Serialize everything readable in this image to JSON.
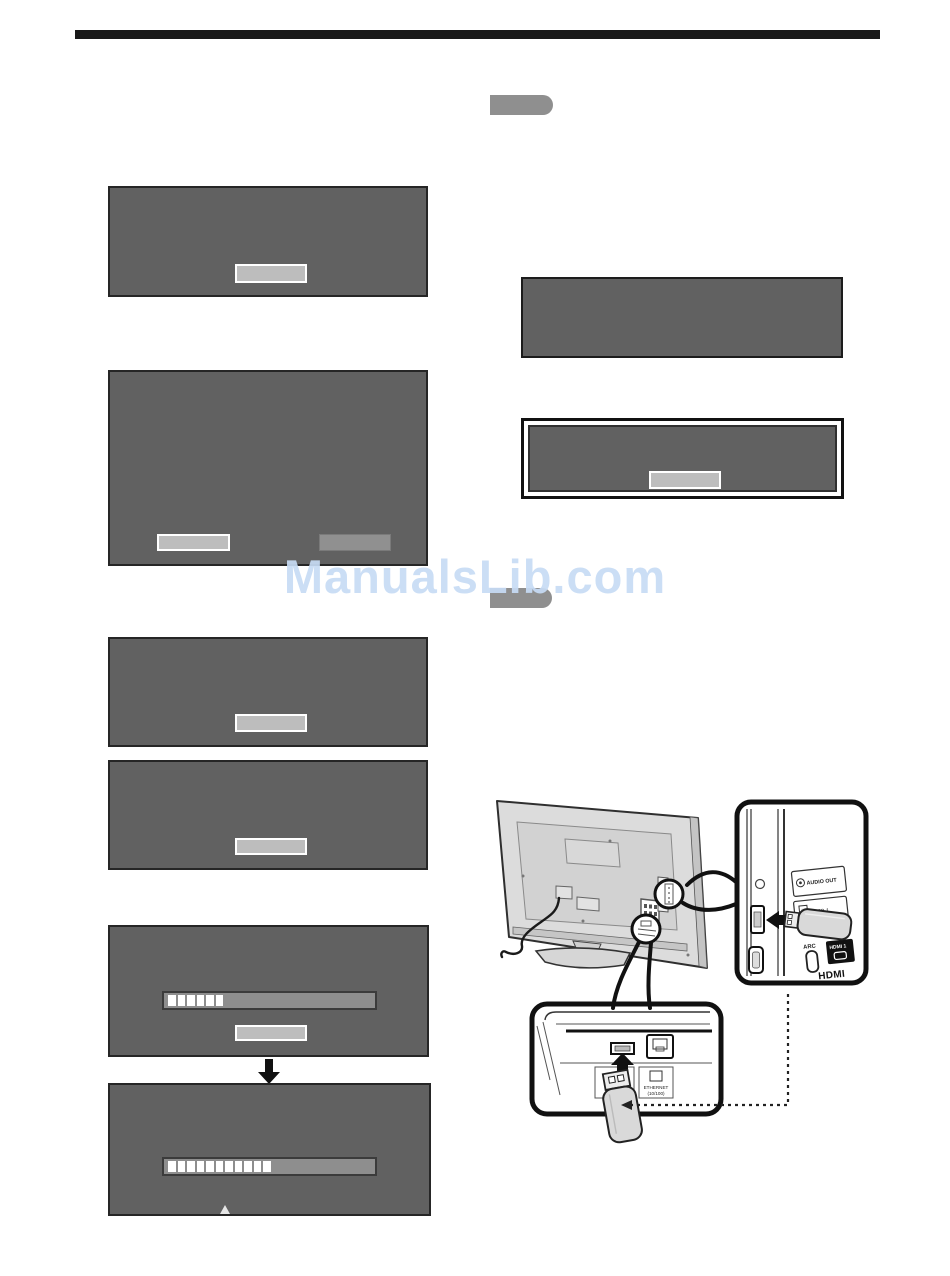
{
  "watermark": {
    "text": "ManualsLib.com",
    "color": "#c7dcf5"
  },
  "screens": {
    "prompt_screen": {
      "button_count": 1
    },
    "confirm_screen": {
      "button_count": 2
    },
    "message_screen_3": {
      "button_count": 1
    },
    "message_screen_4": {
      "button_count": 1
    },
    "download_progress_screen": {
      "filled_segments": 6,
      "button_count": 1
    },
    "install_progress_screen": {
      "filled_segments": 11
    }
  },
  "diagram": {
    "labels": {
      "audio_out": "AUDIO OUT",
      "usb1": "USB 1",
      "arc": "ARC",
      "hdmi1": "HDMI 1",
      "hdmi_logo": "HDMI",
      "ethernet": "ETHERNET",
      "ethernet_speed": "(10/100)"
    }
  },
  "colors": {
    "rule": "#191919",
    "dialog_bg": "#616161",
    "button_highlighted": "#bdbdbd",
    "button_normal": "#909090",
    "tab": "#8f8f8f",
    "progress_track": "#8e8e8e",
    "progress_segment": "#ffffff",
    "watermark": "#c7dcf5"
  }
}
